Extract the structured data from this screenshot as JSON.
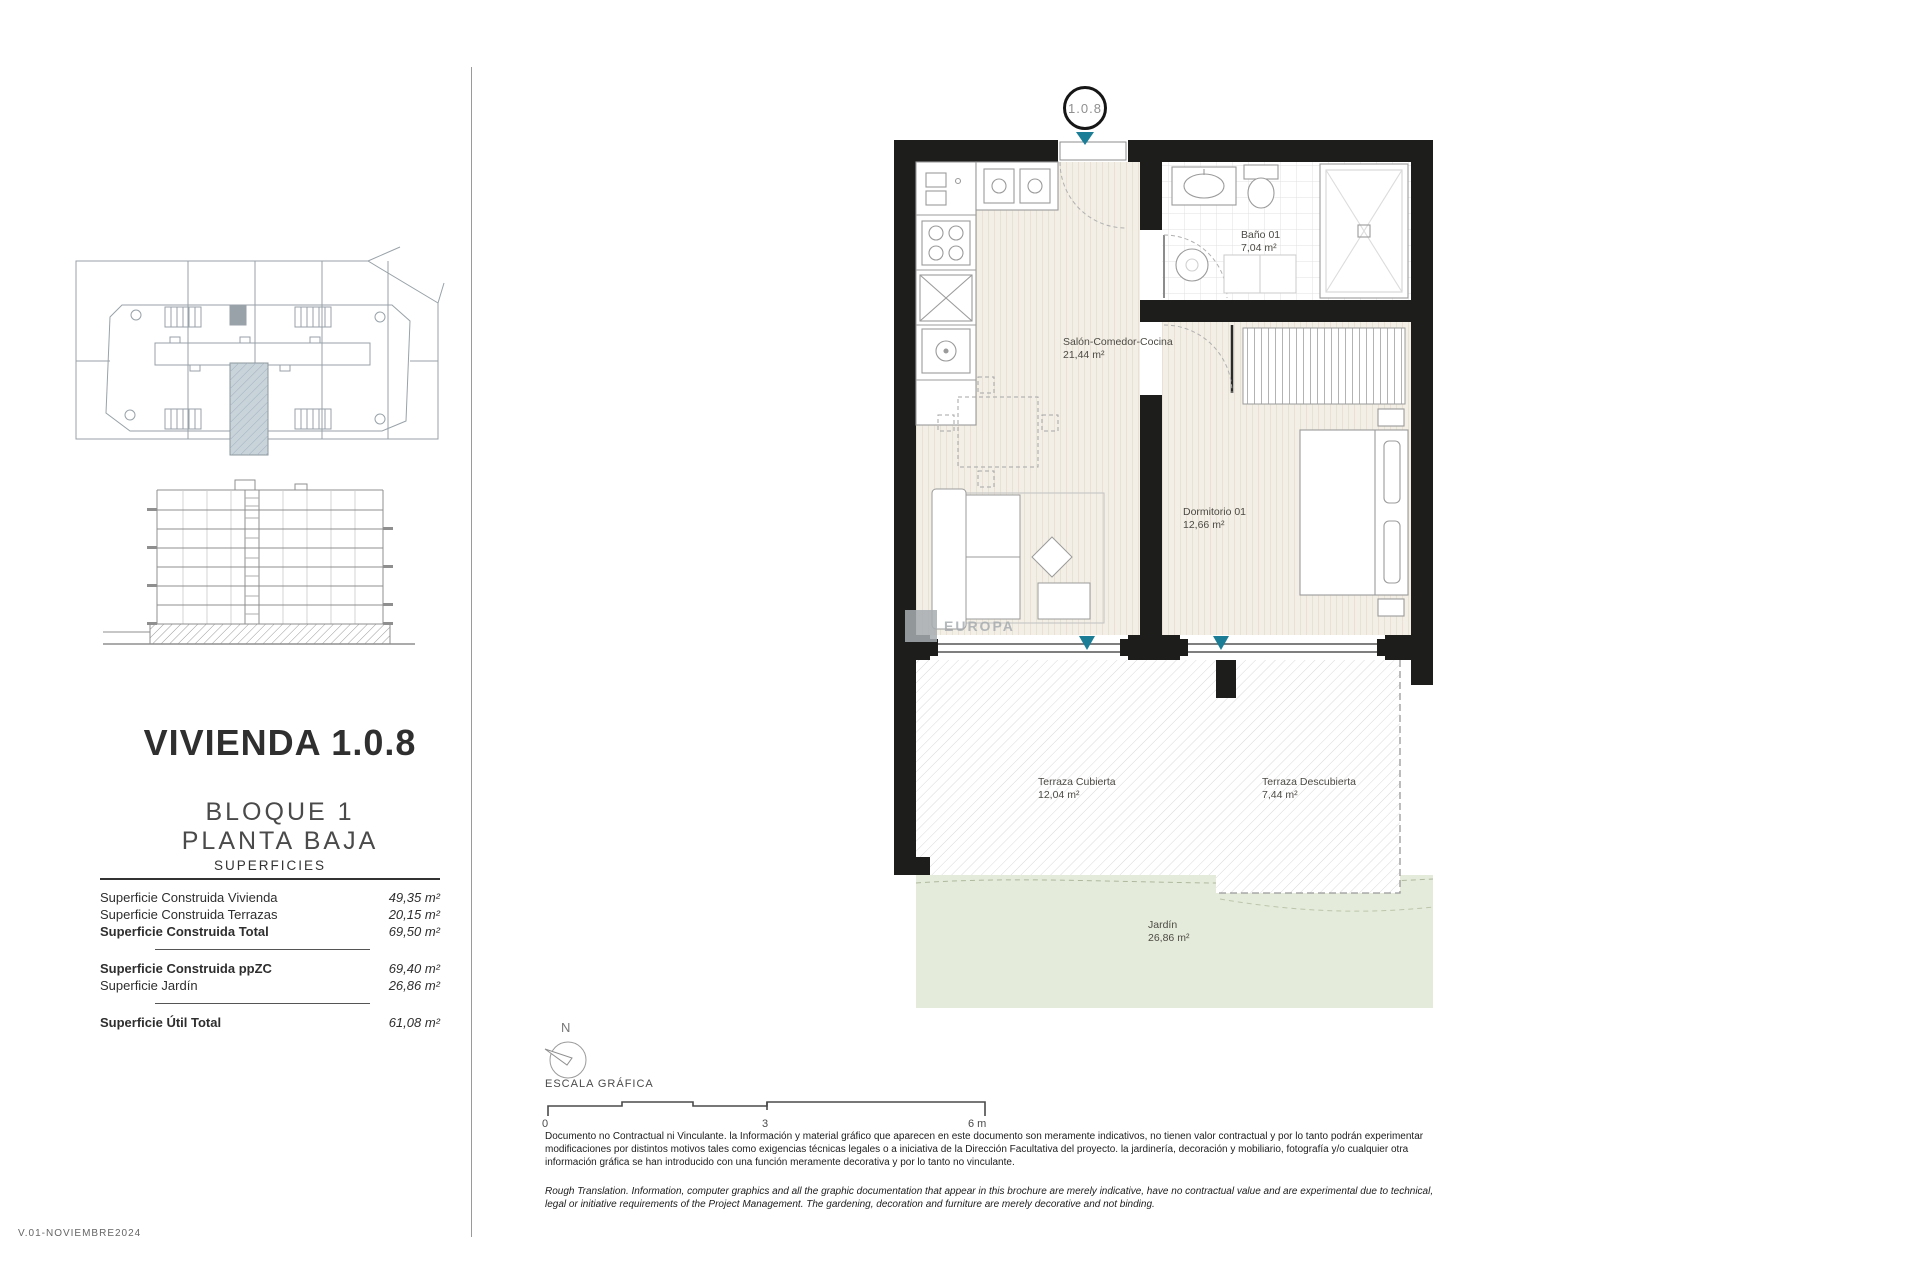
{
  "document": {
    "title": "VIVIENDA 1.0.8",
    "block": "BLOQUE 1",
    "floor": "PLANTA BAJA",
    "version": "V.01-NOVIEMBRE2024"
  },
  "superficies": {
    "heading": "SUPERFICIES",
    "rows": [
      {
        "label": "Superficie Construida Vivienda",
        "value": "49,35 m²"
      },
      {
        "label": "Superficie Construida Terrazas",
        "value": "20,15 m²"
      },
      {
        "label": "Superficie Construida Total",
        "value": "69,50 m²"
      },
      {
        "label": "Superficie Construida ppZC",
        "value": "69,40 m²"
      },
      {
        "label": "Superficie Jardín",
        "value": "26,86 m²"
      },
      {
        "label": "Superficie Útil Total",
        "value": "61,08 m²"
      }
    ]
  },
  "plan": {
    "unit_badge": "1.0.8",
    "watermark": "EUROPA",
    "rooms": [
      {
        "name": "Salón-Comedor-Cocina",
        "area": "21,44 m²"
      },
      {
        "name": "Baño 01",
        "area": "7,04 m²"
      },
      {
        "name": "Dormitorio 01",
        "area": "12,66 m²"
      },
      {
        "name": "Terraza Cubierta",
        "area": "12,04 m²"
      },
      {
        "name": "Terraza Descubierta",
        "area": "7,44 m²"
      },
      {
        "name": "Jardín",
        "area": "26,86 m²"
      }
    ]
  },
  "compass": {
    "north_label": "N"
  },
  "scalebar": {
    "label": "ESCALA GRÁFICA",
    "ticks": [
      "0",
      "3",
      "6 m"
    ]
  },
  "disclaimer": {
    "spanish": "Documento no Contractual ni Vinculante. la Información y material gráfico que aparecen en este documento son meramente indicativos, no tienen valor contractual y por lo tanto podrán experimentar modificaciones por distintos motivos tales como exigencias técnicas legales o a iniciativa de la Dirección Facultativa del proyecto. la jardinería, decoración y mobiliario, fotografía y/o cualquier otra información gráfica se han introducido con una función meramente decorativa y por lo tanto no vinculante.",
    "english": "Rough Translation. Information, computer graphics and all the graphic documentation that appear in this brochure are merely indicative, have no contractual value and are experimental due to technical, legal or initiative requirements of the Project Management. The gardening, decoration and furniture are merely decorative and not binding."
  },
  "colors": {
    "accent": "#1b7e96",
    "garden": "#e5ebdb",
    "wall": "#1d1d1b",
    "floor": "#f3efe6"
  }
}
